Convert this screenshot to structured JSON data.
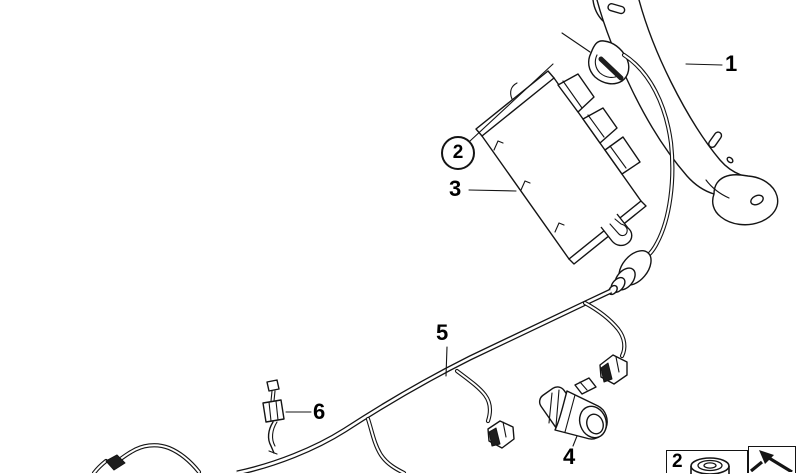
{
  "figure": {
    "kind": "exploded-parts-line-drawing",
    "background_color": "#ffffff",
    "line_color": "#141414",
    "callouts": {
      "c1": "1",
      "c2": "2",
      "c3": "3",
      "c4": "4",
      "c5": "5",
      "c6": "6"
    },
    "legend": {
      "item_number": "2",
      "item_icon": "nut-icon",
      "reference_icon": "arrow-icon"
    }
  }
}
